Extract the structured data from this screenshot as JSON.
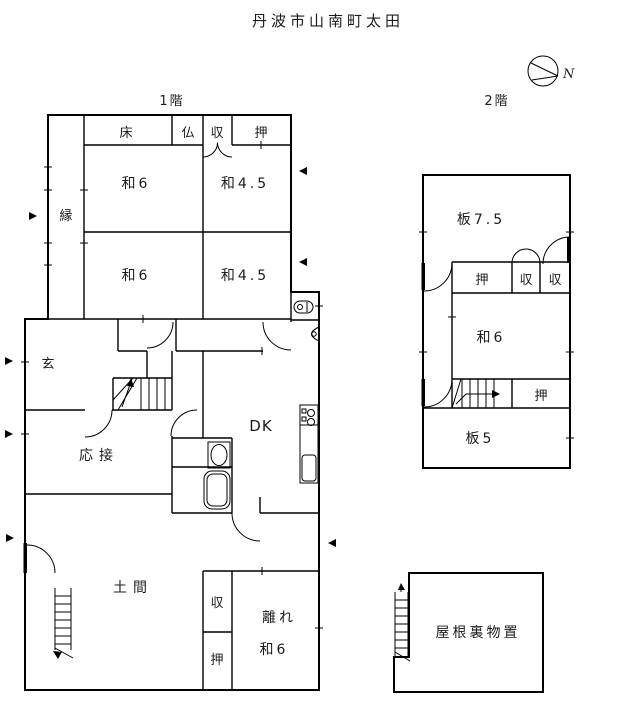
{
  "title": "丹波市山南町太田",
  "compass": {
    "north": "N"
  },
  "floor1": {
    "name": "1階",
    "rooms": {
      "toko": "床",
      "butsudan": "仏",
      "shuno_top": "収",
      "oshiire_top": "押",
      "engawa": "縁",
      "wa6_upper": "和6",
      "wa45_upper": "和4.5",
      "wa6_lower": "和6",
      "wa45_lower": "和4.5",
      "genkan": "玄",
      "ousetsu": "応接",
      "dk": "DK",
      "doma": "土間",
      "shuno_hanare": "収",
      "oshiire_hanare": "押",
      "hanare": "離れ",
      "hanare_wa6": "和6"
    }
  },
  "floor2": {
    "name": "2階",
    "rooms": {
      "ita75": "板7.5",
      "oshiire_upper": "押",
      "shuno_a": "収",
      "shuno_b": "収",
      "wa6": "和6",
      "oshiire_lower": "押",
      "ita5": "板5"
    }
  },
  "attic": {
    "label": "屋根裏物置"
  }
}
